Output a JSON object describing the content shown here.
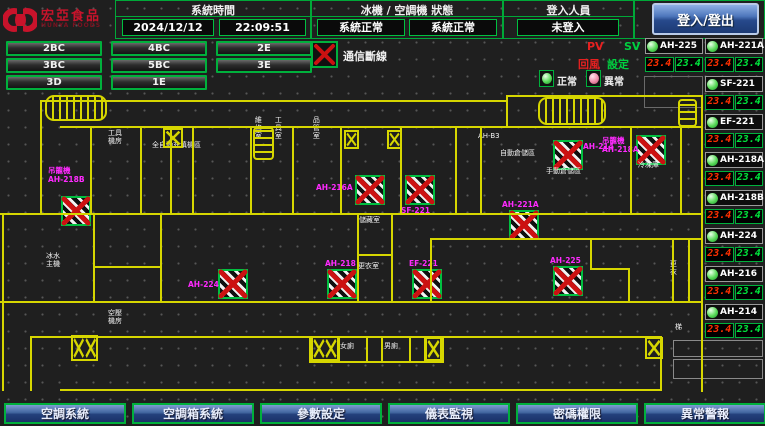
{
  "header": {
    "logo_title": "宏亞食品",
    "logo_subtitle": "HUNYA FOODS",
    "time_label": "系統時間",
    "date": "2024/12/12",
    "time": "22:09:51",
    "status_label": "冰機 / 空調機 狀態",
    "chiller_status": "系統正常",
    "ahu_status": "系統正常",
    "login_label": "登入人員",
    "login_state": "未登入",
    "login_button": "登入/登出"
  },
  "floor_buttons": [
    {
      "label": "2BC",
      "x": 6,
      "y": 41
    },
    {
      "label": "4BC",
      "x": 111,
      "y": 41
    },
    {
      "label": "2E",
      "x": 216,
      "y": 41
    },
    {
      "label": "3BC",
      "x": 6,
      "y": 58
    },
    {
      "label": "5BC",
      "x": 111,
      "y": 58
    },
    {
      "label": "3E",
      "x": 216,
      "y": 58
    },
    {
      "label": "3D",
      "x": 6,
      "y": 75
    },
    {
      "label": "1E",
      "x": 111,
      "y": 75
    }
  ],
  "legend": {
    "comm_loss": "通信斷線",
    "normal": "正常",
    "abnormal": "異常",
    "pv": "PV",
    "sv": "SV",
    "pv_name": "回風",
    "sv_name": "設定"
  },
  "units": [
    {
      "name": "AH-225",
      "pv": "23.4",
      "sv": "23.4",
      "x": 645,
      "y": 38
    },
    {
      "name": "AH-221A",
      "pv": "23.4",
      "sv": "23.4",
      "x": 705,
      "y": 38
    },
    {
      "name": "SF-221",
      "pv": "23.4",
      "sv": "23.4",
      "x": 705,
      "y": 76
    },
    {
      "name": "EF-221",
      "pv": "23.4",
      "sv": "23.4",
      "x": 705,
      "y": 114
    },
    {
      "name": "AH-218A",
      "pv": "23.4",
      "sv": "23.4",
      "x": 705,
      "y": 152
    },
    {
      "name": "AH-218B",
      "pv": "23.4",
      "sv": "23.4",
      "x": 705,
      "y": 190
    },
    {
      "name": "AH-224",
      "pv": "23.4",
      "sv": "23.4",
      "x": 705,
      "y": 228
    },
    {
      "name": "AH-216",
      "pv": "23.4",
      "sv": "23.4",
      "x": 705,
      "y": 266
    },
    {
      "name": "AH-214",
      "pv": "23.4",
      "sv": "23.4",
      "x": 705,
      "y": 304
    }
  ],
  "nav": [
    {
      "label": "空調系統",
      "x": 4
    },
    {
      "label": "空調箱系統",
      "x": 132
    },
    {
      "label": "參數設定",
      "x": 260
    },
    {
      "label": "儀表監視",
      "x": 388
    },
    {
      "label": "密碼權限",
      "x": 516
    },
    {
      "label": "異常警報",
      "x": 644
    }
  ],
  "map": {
    "devices": [
      {
        "x": 61,
        "y": 196
      },
      {
        "x": 355,
        "y": 175
      },
      {
        "x": 405,
        "y": 175
      },
      {
        "x": 327,
        "y": 269
      },
      {
        "x": 412,
        "y": 269
      },
      {
        "x": 509,
        "y": 210
      },
      {
        "x": 553,
        "y": 266
      },
      {
        "x": 218,
        "y": 269
      },
      {
        "x": 553,
        "y": 140
      },
      {
        "x": 636,
        "y": 135
      }
    ],
    "device_labels": [
      {
        "lines": [
          "吊籠機",
          "AH-218B"
        ],
        "x": 48,
        "y": 166
      },
      {
        "text": "AH-216A",
        "x": 316,
        "y": 183
      },
      {
        "text": "SF-221",
        "x": 401,
        "y": 206
      },
      {
        "text": "AH-218",
        "x": 325,
        "y": 259
      },
      {
        "text": "EF-221",
        "x": 409,
        "y": 259
      },
      {
        "text": "AH-221A",
        "x": 502,
        "y": 200
      },
      {
        "text": "AH-225",
        "x": 550,
        "y": 256
      },
      {
        "text": "AH-224",
        "x": 188,
        "y": 280
      },
      {
        "text": "AH-214",
        "x": 583,
        "y": 142
      },
      {
        "lines": [
          "吊籠機",
          "AH-218A"
        ],
        "x": 602,
        "y": 136
      }
    ],
    "room_labels": [
      {
        "lines": [
          "工具",
          "機房"
        ],
        "x": 108,
        "y": 129
      },
      {
        "text": "全自動充填機區",
        "x": 152,
        "y": 141
      },
      {
        "text": "維修室",
        "x": 254,
        "y": 116,
        "vertical": true
      },
      {
        "text": "工具室",
        "x": 274,
        "y": 116,
        "vertical": true
      },
      {
        "text": "品管室",
        "x": 312,
        "y": 116,
        "vertical": true
      },
      {
        "text": "AH-B3",
        "x": 478,
        "y": 132
      },
      {
        "text": "自動倉儲區",
        "x": 500,
        "y": 149
      },
      {
        "text": "手動倉儲區",
        "x": 546,
        "y": 167
      },
      {
        "text": "冷凍庫",
        "x": 638,
        "y": 161
      },
      {
        "text": "儲藏室",
        "x": 359,
        "y": 216
      },
      {
        "text": "更衣室",
        "x": 358,
        "y": 262
      },
      {
        "lines": [
          "冰水",
          "主機"
        ],
        "x": 46,
        "y": 252
      },
      {
        "lines": [
          "空壓",
          "機房"
        ],
        "x": 108,
        "y": 309
      },
      {
        "text": "女廁",
        "x": 340,
        "y": 342
      },
      {
        "text": "男廁",
        "x": 384,
        "y": 342
      },
      {
        "text": "更衣",
        "x": 669,
        "y": 260,
        "vertical": true
      },
      {
        "text": "梯",
        "x": 675,
        "y": 323
      }
    ]
  },
  "colors": {
    "accent_green": "#00b03c",
    "alarm_red": "#cc1111",
    "magenta": "#ff2aff",
    "map_yellow": "#d6d600",
    "value_red": "#ff3000",
    "value_green": "#00e53c",
    "button_blue": "#24407c"
  }
}
